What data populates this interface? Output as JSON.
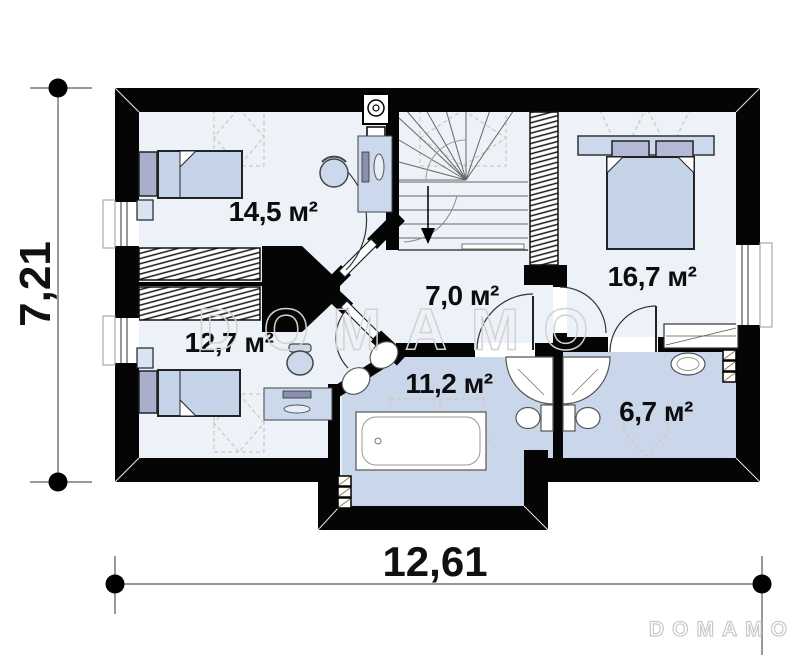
{
  "rooms": [
    {
      "id": "bedroom-top-left",
      "area": "14,5 м²"
    },
    {
      "id": "bedroom-bottom-left",
      "area": "12,7 м²"
    },
    {
      "id": "hall",
      "area": "7,0 м²"
    },
    {
      "id": "bathroom",
      "area": "11,2 м²"
    },
    {
      "id": "bedroom-right",
      "area": "16,7 м²"
    },
    {
      "id": "ensuite-bathroom",
      "area": "6,7 м²"
    }
  ],
  "dimensions": {
    "overall_width": "12,61",
    "overall_height": "7,21"
  },
  "watermark_text": "DOMAMO",
  "brand_text": "DOMAMO",
  "colors": {
    "wall": "#050505",
    "room_floor": "#edf2f9",
    "wet_room_floor": "#cad6ea",
    "furniture_fill": "#ccd9ec",
    "furniture_accent": "#a9afcb",
    "bed_fill": "#c5d3e9",
    "roof_dash": "#d2cabb",
    "watermark": "#d2d2d2"
  }
}
